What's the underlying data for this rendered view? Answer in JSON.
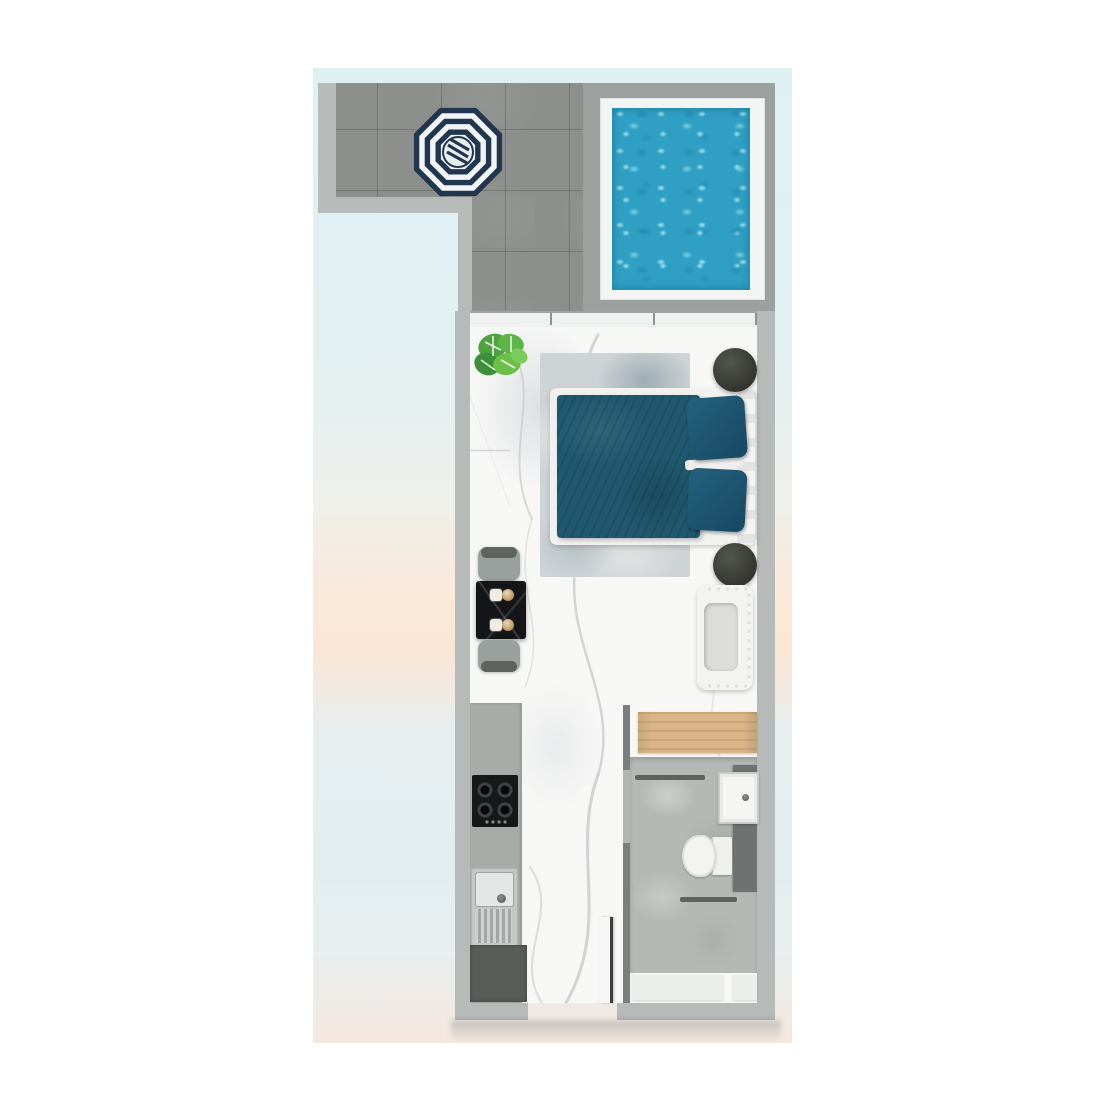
{
  "image": {
    "type": "3d-floor-plan-top-view",
    "description": "Studio apartment floor plan with L-shaped tiled terrace, private plunge pool, bedroom-living area, dining nook, kitchenette strip and bathroom",
    "text_labels": []
  },
  "background": {
    "page_color": "#ffffff",
    "sky_top": "#dff0f3",
    "peach_band": "#fbe9da",
    "sky_bottom": "#e2edef"
  },
  "walls": {
    "outer_color": "#b6bab8",
    "inner_color": "#7a7e7c"
  },
  "outdoor": {
    "terrace": {
      "shape": "L",
      "tile_color": "#8c8f8c",
      "umbrella": {
        "shape": "octagon",
        "rings": "concentric stripes",
        "navy": "#22374e",
        "white": "#f2f5f7"
      }
    },
    "pool": {
      "surround_color": "#9ca09f",
      "deck_color": "#f3f5f4",
      "water_color": "#2fa0c4",
      "water_sparkle": "#8fdcec"
    }
  },
  "interior": {
    "floor": {
      "material": "white marble",
      "base_color": "#f7f7f6",
      "vein_color": "#c6cacd"
    },
    "window_wall": {
      "position": "top of unit",
      "panel_dividers": 3
    },
    "bedroom": {
      "plant": {
        "type": "monstera",
        "greens": [
          "#5fb447",
          "#3e8f3a",
          "#7bca5d"
        ]
      },
      "tv_console": {
        "color": "#1d1f22"
      },
      "rug": {
        "color": "#ced3d6"
      },
      "bed": {
        "duvet_color": "#20596f",
        "pillow_color": "#1d5370",
        "pillow_count": 2,
        "frame_color": "#f1f1ef",
        "headboard_side": "right"
      },
      "round_side_stools": {
        "count": 2,
        "color": "#3f413e"
      }
    },
    "dining": {
      "table_color": "#141517",
      "chair_count": 2,
      "chair_color": "#9aa09e",
      "place_settings": 2,
      "dish_color": "#c29a63"
    },
    "lounge_chair": {
      "body_color": "#f3f3f1",
      "seat_color": "#dcdcd8",
      "trim": "fringe"
    },
    "wardrobe": {
      "material": "wood",
      "color": "#d9b587"
    },
    "kitchen": {
      "counter_color": "#a9aba8",
      "hob": {
        "burner_count": 4,
        "color": "#17181a"
      },
      "sink": {
        "style": "bowl with drainer",
        "color": "#c3c7c5"
      },
      "base_cabinet_color": "#595d5a"
    },
    "bathroom": {
      "floor_color": "#b5b9b6",
      "partition_color": "#6e7270",
      "toilet_color": "#f3f4f2",
      "basin_color": "#f5f6f4",
      "towel_bar_count": 2,
      "mat_count": 2
    },
    "entry_door": {
      "state": "open leaf against corridor wall",
      "leaf_color": "#f6f7f6",
      "frame_color": "#3c3e3d"
    }
  }
}
